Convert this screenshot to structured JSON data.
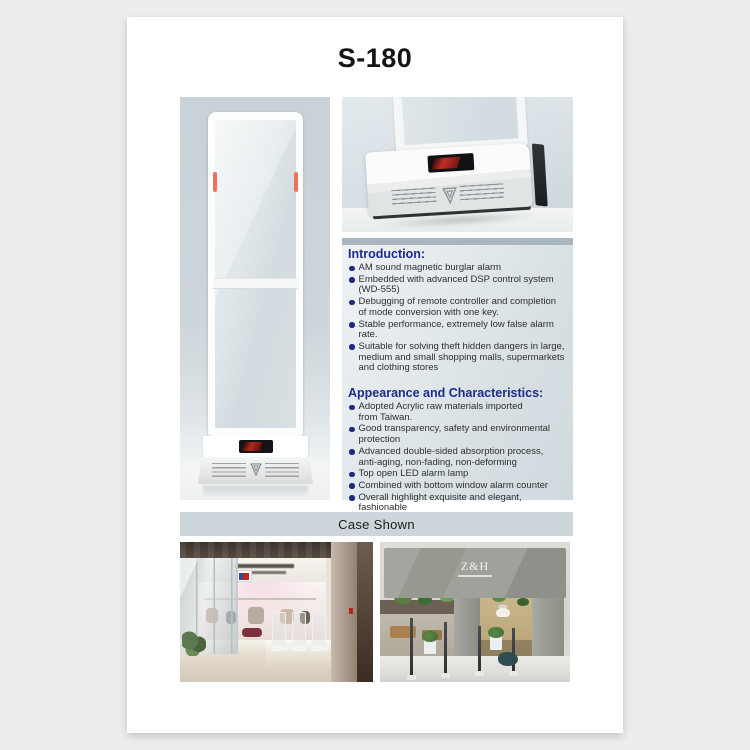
{
  "page": {
    "title": "S-180",
    "background_color": "#ededed",
    "sheet_color": "#ffffff"
  },
  "info_panel": {
    "sections": [
      {
        "heading": "Introduction:",
        "bullets": [
          "AM sound magnetic burglar alarm",
          "Embedded with advanced DSP control system\n(WD-555)",
          "Debugging of remote controller and completion\nof mode conversion with one key.",
          "Stable performance, extremely low false alarm rate.",
          "Suitable for solving theft hidden dangers in large,\nmedium and small shopping malls, supermarkets\nand clothing stores"
        ]
      },
      {
        "heading": "Appearance and Characteristics:",
        "bullets": [
          "Adopted Acrylic raw materials  imported\nfrom Taiwan.",
          "Good transparency, safety and environmental\nprotection",
          "Advanced double-sided absorption process,\nanti-aging, non-fading, non-deforming",
          "Top open LED alarm lamp",
          "Combined with bottom window alarm counter",
          "Overall highlight exquisite and elegant, fashionable\nand luxurious, leading the industry trend."
        ]
      }
    ]
  },
  "case_shown": {
    "label": "Case Shown"
  },
  "photos": {
    "right_store_sign": "Z&H"
  },
  "colors": {
    "heading_blue": "#1c2b8c",
    "panel_top_band": "#a9b5bf",
    "panel_background": "#dfe6ea",
    "case_band_background": "#ccd5da",
    "led_strip_red": "#f2705b",
    "display_red": "#b32b20",
    "render_background": "#ccd5da"
  }
}
